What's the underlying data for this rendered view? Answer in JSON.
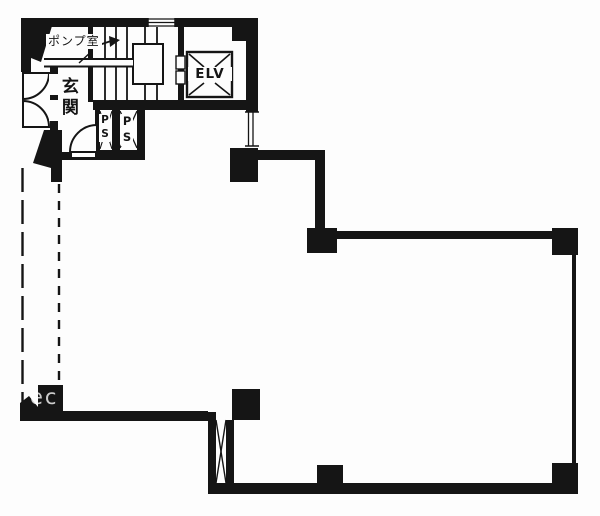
{
  "plan": {
    "title": "building-floor-plan",
    "labels": {
      "pump_room": "ポンプ室",
      "entrance": "玄関",
      "elevator": "ELV",
      "pipe_space_left": "PS",
      "pipe_space_right": "PS"
    },
    "watermark": "ec",
    "colors": {
      "ink": "#151515",
      "paper": "#fdfdfd"
    }
  }
}
